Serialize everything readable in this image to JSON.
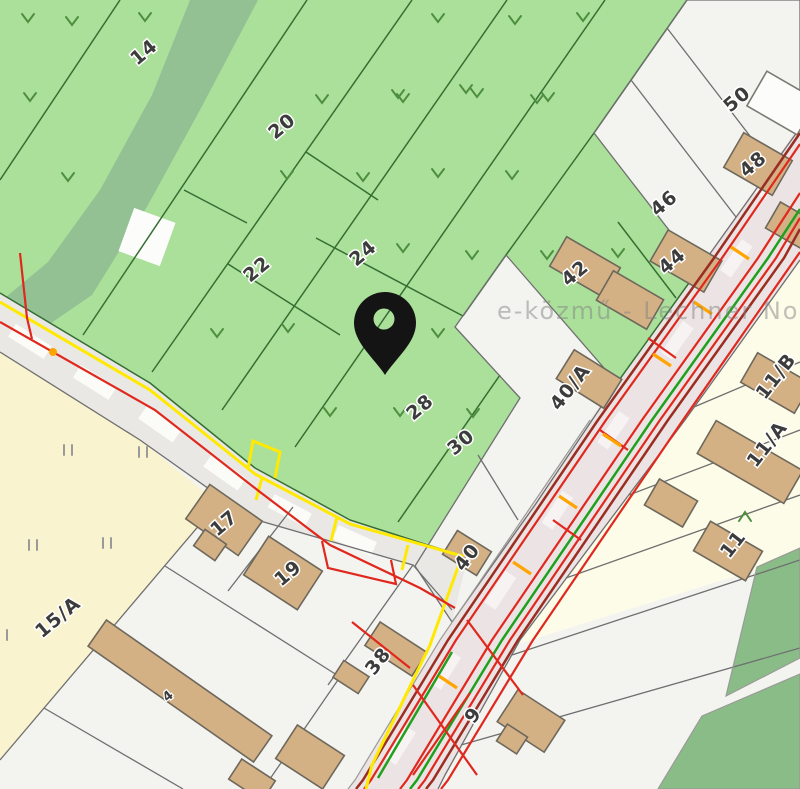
{
  "map": {
    "watermark": "e-közmű - Lechner Nonpr",
    "pin": {
      "x": 385,
      "y": 325
    },
    "labels": [
      {
        "text": "14",
        "transform": "translate(148 57) rotate(-40)"
      },
      {
        "text": "20",
        "transform": "translate(286 131) rotate(-40)"
      },
      {
        "text": "22",
        "transform": "translate(261 274) rotate(-40)"
      },
      {
        "text": "24",
        "transform": "translate(367 258) rotate(-40)"
      },
      {
        "text": "28",
        "transform": "translate(424 412) rotate(-40)"
      },
      {
        "text": "30",
        "transform": "translate(465 447) rotate(-40)"
      },
      {
        "text": "42",
        "transform": "translate(579 278) rotate(-40)"
      },
      {
        "text": "44",
        "transform": "translate(676 266) rotate(-40)"
      },
      {
        "text": "46",
        "transform": "translate(668 208) rotate(-40)"
      },
      {
        "text": "48",
        "transform": "translate(757 169) rotate(-40)"
      },
      {
        "text": "50",
        "transform": "translate(741 104) rotate(-40)"
      },
      {
        "text": "40/A",
        "transform": "translate(575 391) rotate(-52)"
      },
      {
        "text": "40",
        "transform": "translate(472 561) rotate(-52)"
      },
      {
        "text": "38",
        "transform": "translate(383 665) rotate(-52)"
      },
      {
        "text": "17",
        "transform": "translate(228 528) rotate(-40)"
      },
      {
        "text": "19",
        "transform": "translate(292 578) rotate(-40)"
      },
      {
        "text": "15/A",
        "transform": "translate(62 622) rotate(-40)"
      },
      {
        "text": "9",
        "transform": "translate(478 719) rotate(-52)"
      },
      {
        "text": "11/B",
        "transform": "translate(781 380) rotate(-52)"
      },
      {
        "text": "11/A",
        "transform": "translate(772 448) rotate(-52)"
      },
      {
        "text": "11",
        "transform": "translate(738 548) rotate(-52)"
      },
      {
        "text": "4",
        "transform": "translate(171 699) rotate(-40)"
      }
    ],
    "colors": {
      "parcel_green": "#abe09a",
      "wood_green": "#93c193",
      "parcel_white": "#f3f3f0",
      "parcel_cream": "#faf3cf",
      "parcel_ivory": "#fdfce9",
      "parcel_mid_green": "#8abc88",
      "road": "#e9e8e5",
      "corridor_road": "#ece4e4",
      "building": "#d3b185",
      "building_stroke": "#6e685c",
      "line_red": "#e0281e",
      "line_maroon": "#9b2d22",
      "line_green": "#1fa11f",
      "line_yellow": "#ffe900",
      "line_orange": "#ffa400",
      "boundary_green": "#356e33",
      "boundary_gray": "#6f6f6f",
      "pin": "#141414",
      "label": "#3c3c3c"
    }
  }
}
